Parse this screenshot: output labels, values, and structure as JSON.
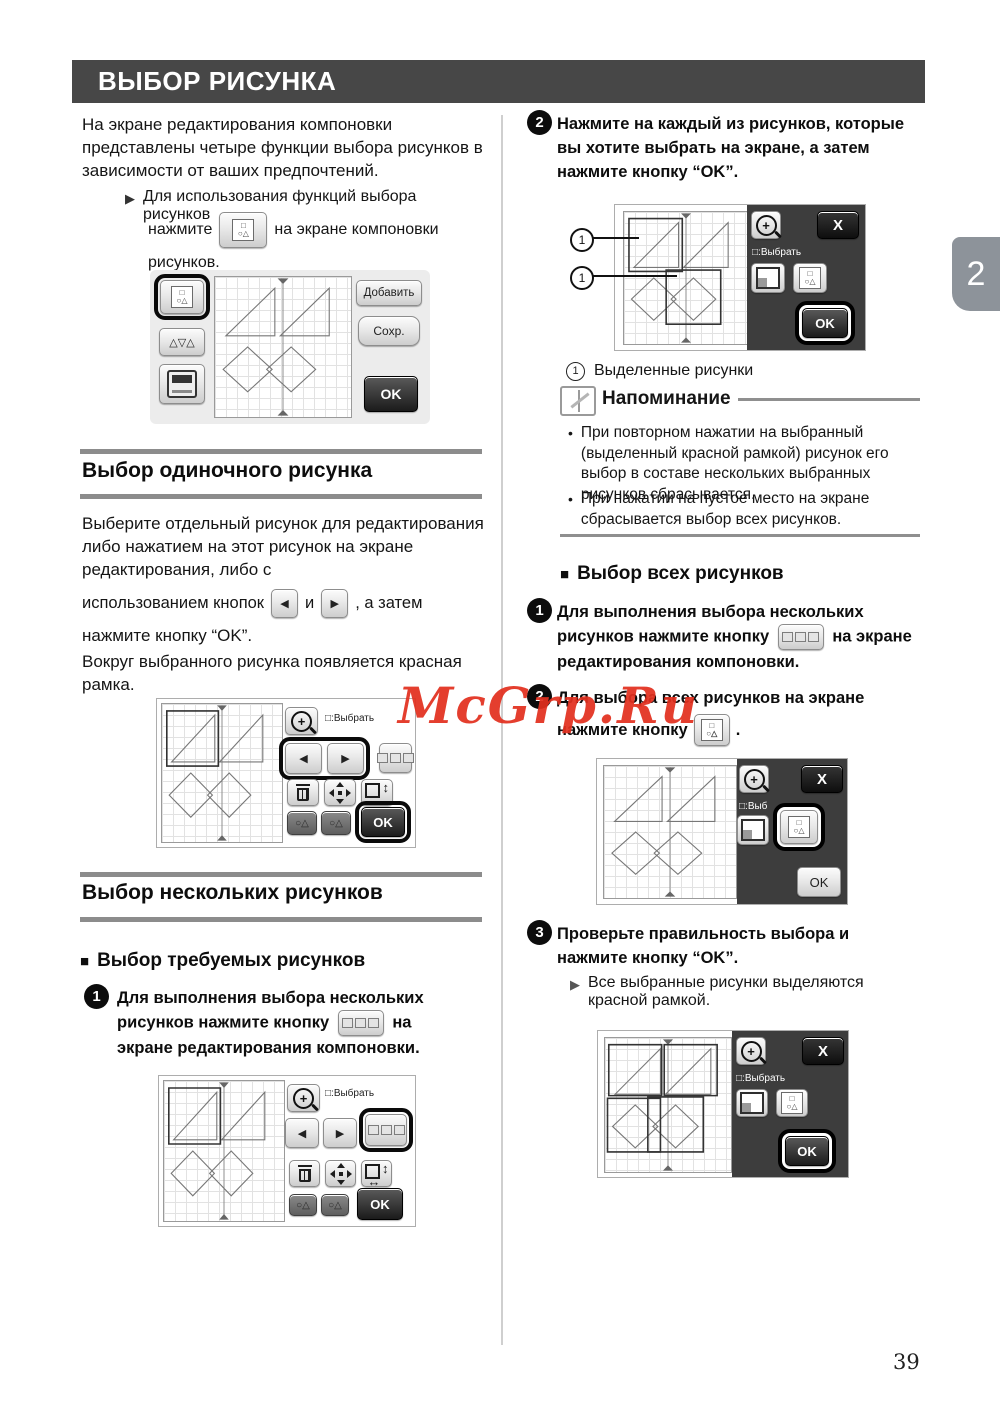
{
  "page": {
    "number": "39",
    "chapter_tab": "2",
    "watermark": "McGrp.Ru"
  },
  "header": {
    "title": "ВЫБОР РИСУНКА"
  },
  "icons": {
    "bullet_arrow": "▶",
    "left_arrow": "◀",
    "right_arrow": "▶",
    "square_marker": "■",
    "dot": "•",
    "triangles_button": "△▽△",
    "zoom_plus": "+",
    "pattern_row1": "□",
    "pattern_row2": "○△",
    "weld_shapes": "○△",
    "updown": "↕",
    "leftright": "↔"
  },
  "screens": {
    "add": "Добавить",
    "save": "Сохр.",
    "ok": "OK",
    "close": "X",
    "select_label": "□:Выбрать",
    "select_label_short": "□:Выб"
  },
  "left": {
    "intro": "На экране редактирования компоновки représентированы... На экране редактирования компоновки представлены четыре функции выбора рисунков в зависимости от ваших предпочтений.",
    "bullet1": "Для использования функций выбора рисунков",
    "bullet2_pre": "нажмите",
    "bullet2_post": "на экране компоновки",
    "bullet2_tail": "рисунков.",
    "single_title": "Выбор одиночного рисунка",
    "single_p1": "Выберите отдельный рисунок для редактирования либо нажатием на этот рисунок на экране редактирования, либо с",
    "single_p2_pre": "использованием кнопок",
    "single_p2_mid": "и",
    "single_p2_post": ", а затем",
    "single_p3": "нажмите кнопку “OK”.",
    "single_p4": "Вокруг выбранного рисунка появляется красная рамка.",
    "multi_title": "Выбор нескольких рисунков",
    "multi_sub": "Выбор требуемых рисунков",
    "step1_num": "1",
    "step1_pre": "Для выполнения выбора нескольких рисунков нажмите кнопку",
    "step1_post": "на экране редактирования компоновки."
  },
  "right": {
    "step2_num": "2",
    "step2_text": "Нажмите на каждый из рисунков, которые вы хотите выбрать на экране, а затем нажмите кнопку “OK”.",
    "callout_num": "1",
    "caption_num": "1",
    "caption_text": "Выделенные рисунки",
    "note_title": "Напоминание",
    "note_b1": "При повторном нажатии на выбранный (выделенный красной рамкой) рисунок его выбор в составе нескольких выбранных рисунков сбрасывается.",
    "note_b2": "При нажатии на пустое место на экране сбрасывается выбор всех рисунков.",
    "all_title": "Выбор всех рисунков",
    "all_step1_num": "1",
    "all_step1_pre": "Для выполнения выбора нескольких рисунков нажмите кнопку",
    "all_step1_post": "на экране редактирования компоновки.",
    "all_step2_num": "2",
    "all_step2_line1": "Для выбора всех рисунков на экране",
    "all_step2_pre": "нажмите кнопку",
    "all_step2_post": ".",
    "step3_num": "3",
    "step3_text": "Проверьте правильность выбора и нажмите кнопку “OK”.",
    "step3_bullet": "Все выбранные рисунки выделяются красной рамкой."
  }
}
